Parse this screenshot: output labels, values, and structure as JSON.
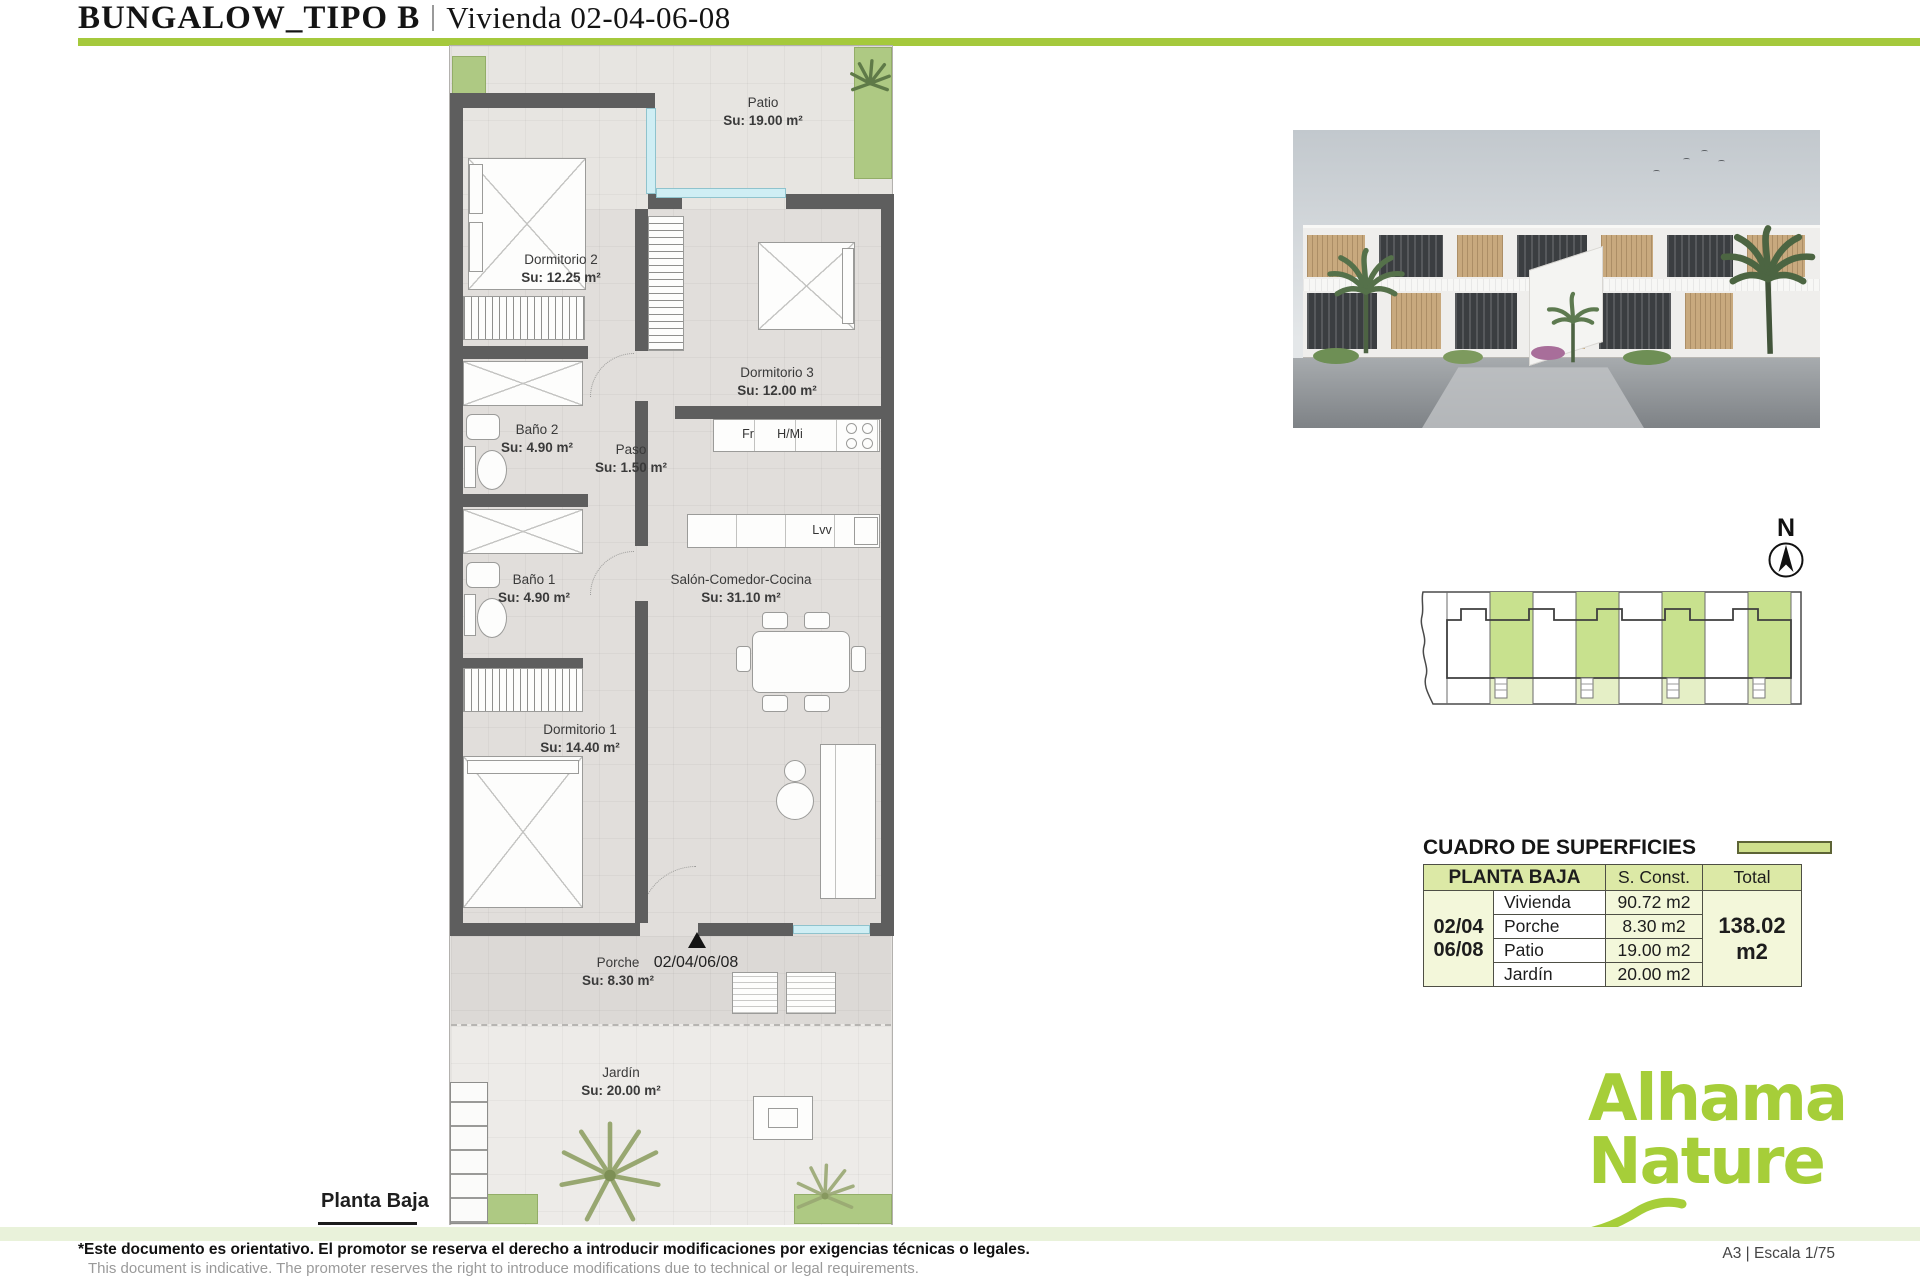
{
  "header": {
    "title_main": "BUNGALOW_TIPO B",
    "title_sub": "Vivienda 02-04-06-08"
  },
  "colors": {
    "accent_green": "#a5c93c",
    "logo_green": "#a6ce39",
    "table_header_green": "#dce9a6",
    "site_plan_green": "#c8e18e"
  },
  "floor_plan": {
    "rooms": [
      {
        "name": "Patio",
        "area": "Su: 19.00 m²"
      },
      {
        "name": "Dormitorio 2",
        "area": "Su: 12.25 m²"
      },
      {
        "name": "Dormitorio 3",
        "area": "Su: 12.00 m²"
      },
      {
        "name": "Baño 2",
        "area": "Su: 4.90 m²"
      },
      {
        "name": "Paso",
        "area": "Su: 1.50 m²"
      },
      {
        "name": "Salón-Comedor-Cocina",
        "area": "Su: 31.10 m²"
      },
      {
        "name": "Baño 1",
        "area": "Su: 4.90 m²"
      },
      {
        "name": "Dormitorio 1",
        "area": "Su: 14.40 m²"
      },
      {
        "name": "Porche",
        "area": "Su: 8.30 m²"
      },
      {
        "name": "Jardín",
        "area": "Su: 20.00 m²"
      }
    ],
    "appliances": {
      "fridge": "Fr",
      "hob_oven": "H/Mi",
      "dishwasher": "Lvv"
    },
    "entrance_label": "02/04/06/08",
    "floor_label": "Planta Baja"
  },
  "compass": {
    "north": "N"
  },
  "surfaces_table": {
    "title": "CUADRO DE SUPERFICIES",
    "header": {
      "zone": "PLANTA BAJA",
      "constructed": "S. Const.",
      "total": "Total"
    },
    "unit_line1": "02/04",
    "unit_line2": "06/08",
    "rows": [
      {
        "label": "Vivienda",
        "value": "90.72 m2"
      },
      {
        "label": "Porche",
        "value": "8.30 m2"
      },
      {
        "label": "Patio",
        "value": "19.00 m2"
      },
      {
        "label": "Jardín",
        "value": "20.00 m2"
      }
    ],
    "total_value": "138.02 m2"
  },
  "brand": {
    "logo_line1": "Alhama",
    "logo_line2": "Nature"
  },
  "footer": {
    "disclaimer_primary": "*Este documento es orientativo. El promotor se reserva el derecho a introducir modificaciones por exigencias técnicas o legales.",
    "disclaimer_secondary": "This document is indicative. The promoter reserves the right to introduce modifications due to technical or legal requirements.",
    "sheet_info": "A3 | Escala 1/75"
  }
}
